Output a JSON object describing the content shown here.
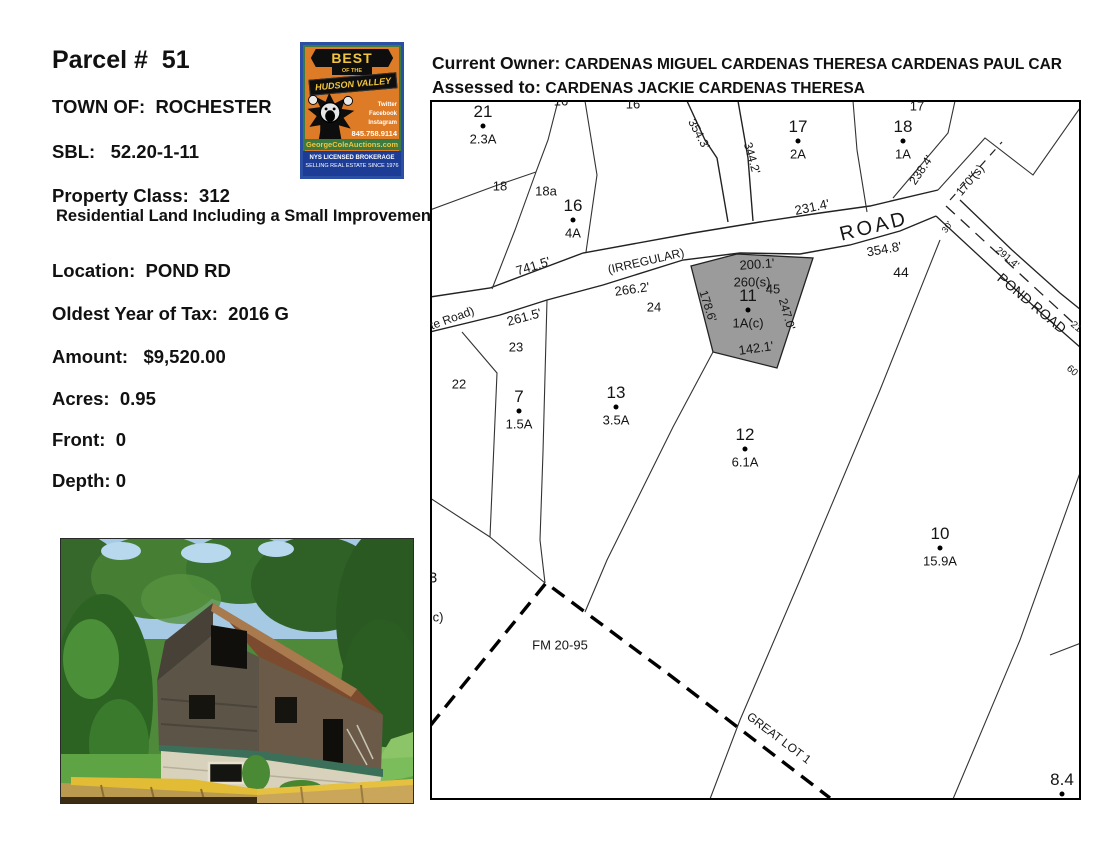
{
  "colors": {
    "logo_orange": "#dd7b26",
    "logo_blue": "#2b4fa2",
    "logo_green": "#3d7a3f",
    "logo_gold": "#f2c53d",
    "logo_footer_blue": "#1c3c96",
    "gray_parcel_fill": "#9b9b9b"
  },
  "left_panel": {
    "title": "Parcel #  51",
    "fields": [
      {
        "text": "TOWN OF:  ROCHESTER"
      },
      {
        "text": "SBL:   52.20-1-11"
      },
      {
        "text": "Property Class:  312"
      },
      {
        "text": "Residential Land Including a Small Improvement"
      },
      {
        "text": "Location:  POND RD"
      },
      {
        "text": "Oldest Year of Tax:  2016 G"
      },
      {
        "text": "Amount:   $9,520.00"
      },
      {
        "text": "Acres:  0.95"
      },
      {
        "text": "Front:  0"
      },
      {
        "text": "Depth: 0"
      }
    ]
  },
  "header": {
    "owner_label": "Current Owner:",
    "owner_value": "CARDENAS MIGUEL CARDENAS THERESA CARDENAS PAUL CAR",
    "assessed_label": "Assessed to:",
    "assessed_value": "CARDENAS JACKIE CARDENAS THERESA"
  },
  "logo": {
    "banner": "BEST",
    "banner_sub": "OF THE",
    "title": "HUDSON VALLEY",
    "social": [
      "Twitter",
      "Facebook",
      "Instagram"
    ],
    "phone": "845.758.9114",
    "website": "GeorgeColeAuctions.com",
    "footer_line1": "NYS LICENSED BROKERAGE",
    "footer_line2": "SELLING REAL ESTATE SINCE 1976"
  },
  "map": {
    "parcels": [
      {
        "num": "21",
        "acres": "2.3A",
        "x": 483,
        "y": 126
      },
      {
        "num": "16",
        "acres": "4A",
        "x": 573,
        "y": 220
      },
      {
        "num": "17",
        "acres": "2A",
        "x": 798,
        "y": 141
      },
      {
        "num": "18",
        "acres": "1A",
        "x": 903,
        "y": 141
      },
      {
        "num": "11",
        "acres": "1A(c)",
        "x": 748,
        "y": 310
      },
      {
        "num": "7",
        "acres": "1.5A",
        "x": 519,
        "y": 411
      },
      {
        "num": "13",
        "acres": "3.5A",
        "x": 616,
        "y": 407
      },
      {
        "num": "12",
        "acres": "6.1A",
        "x": 745,
        "y": 449
      },
      {
        "num": "10",
        "acres": "15.9A",
        "x": 940,
        "y": 548
      },
      {
        "num": "8.4",
        "acres": "",
        "x": 1062,
        "y": 794
      }
    ],
    "labels": [
      {
        "t": "16",
        "x": 561,
        "y": 101,
        "s": 13
      },
      {
        "t": "16",
        "x": 633,
        "y": 104,
        "s": 13
      },
      {
        "t": "17",
        "x": 917,
        "y": 106,
        "s": 13
      },
      {
        "t": "18",
        "x": 500,
        "y": 186,
        "s": 13
      },
      {
        "t": "18a",
        "x": 546,
        "y": 191,
        "s": 13
      },
      {
        "t": "45",
        "x": 773,
        "y": 289,
        "s": 13
      },
      {
        "t": "44",
        "x": 901,
        "y": 272,
        "s": 14
      },
      {
        "t": "24",
        "x": 654,
        "y": 307,
        "s": 13
      },
      {
        "t": "23",
        "x": 516,
        "y": 347,
        "s": 13
      },
      {
        "t": "22",
        "x": 459,
        "y": 384,
        "s": 13
      },
      {
        "t": "3",
        "x": 433,
        "y": 578,
        "s": 15
      },
      {
        "t": "c)",
        "x": 438,
        "y": 617,
        "s": 13
      },
      {
        "t": "741.5'",
        "x": 533,
        "y": 266,
        "r": -17,
        "s": 13
      },
      {
        "t": "(IRREGULAR)",
        "x": 646,
        "y": 261,
        "r": -13,
        "s": 12
      },
      {
        "t": "te Road)",
        "x": 452,
        "y": 318,
        "r": -20,
        "s": 12
      },
      {
        "t": "261.5'",
        "x": 524,
        "y": 317,
        "r": -15,
        "s": 13
      },
      {
        "t": "266.2'",
        "x": 632,
        "y": 289,
        "r": -8,
        "s": 13
      },
      {
        "t": "231.4'",
        "x": 812,
        "y": 207,
        "r": -12,
        "s": 13
      },
      {
        "t": "ROAD",
        "x": 874,
        "y": 227,
        "r": -14,
        "s": 20,
        "ls": 3
      },
      {
        "t": "354.8'",
        "x": 884,
        "y": 249,
        "r": -10,
        "s": 13
      },
      {
        "t": "354.3'",
        "x": 699,
        "y": 134,
        "r": 62,
        "s": 12
      },
      {
        "t": "344.2'",
        "x": 752,
        "y": 158,
        "r": 74,
        "s": 12
      },
      {
        "t": "238.4'",
        "x": 921,
        "y": 170,
        "r": -56,
        "s": 12
      },
      {
        "t": "170'(s)",
        "x": 970,
        "y": 180,
        "r": -50,
        "s": 12
      },
      {
        "t": "30'",
        "x": 947,
        "y": 227,
        "r": -55,
        "s": 9
      },
      {
        "t": "291.4'",
        "x": 1007,
        "y": 258,
        "r": 40,
        "s": 10
      },
      {
        "t": "POND ROAD",
        "x": 1032,
        "y": 303,
        "r": 40,
        "s": 14
      },
      {
        "t": "200.1'",
        "x": 757,
        "y": 264,
        "r": -4,
        "s": 13
      },
      {
        "t": "260(s)",
        "x": 752,
        "y": 282,
        "r": 0,
        "s": 13
      },
      {
        "t": "142.1'",
        "x": 756,
        "y": 348,
        "r": -8,
        "s": 13
      },
      {
        "t": "178.6'",
        "x": 708,
        "y": 306,
        "r": 72,
        "s": 12
      },
      {
        "t": "247.0'",
        "x": 787,
        "y": 314,
        "r": 74,
        "s": 12
      },
      {
        "t": "FM 20-95",
        "x": 560,
        "y": 645,
        "r": 0,
        "s": 13
      },
      {
        "t": "GREAT LOT 1",
        "x": 779,
        "y": 738,
        "r": 37,
        "s": 12
      },
      {
        "t": "21",
        "x": 1076,
        "y": 327,
        "r": 40,
        "s": 10
      },
      {
        "t": "60",
        "x": 1072,
        "y": 371,
        "r": 40,
        "s": 10
      }
    ]
  }
}
